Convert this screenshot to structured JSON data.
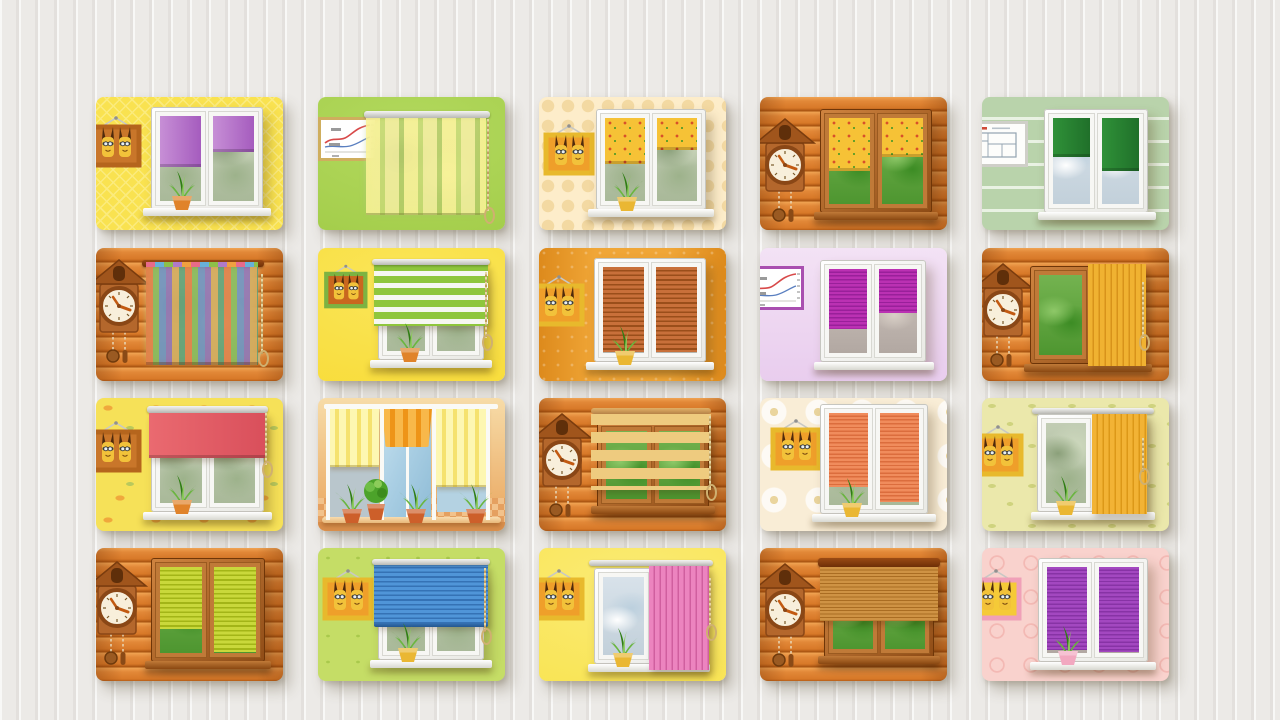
{
  "canvas": {
    "width": 1280,
    "height": 720,
    "background": "#eceae7",
    "stripe": "#d8d5d0"
  },
  "grid": {
    "cols_x": [
      96,
      318,
      539,
      760,
      982
    ],
    "rows_y": [
      97,
      248,
      398,
      548
    ],
    "card_w": 187,
    "card_h": 133,
    "radius": 8
  },
  "palette": {
    "pvc_frame": "#f6f6f2",
    "wood_frame": "#b4672c",
    "pots": {
      "orange": "#e0832a",
      "yellow": "#eab733",
      "pink": "#f2a8c0"
    },
    "critter_body": "#f2c23a",
    "critter_ear": "#4f2a0c",
    "chain_gold": "#cfb070"
  },
  "cards": [
    {
      "id": "r1c1",
      "name": "purple-roller-blinds",
      "wall": {
        "type": "diamond",
        "c1": "#f9e250",
        "c2": "#fbeb7d"
      },
      "elements": [
        {
          "kind": "frame",
          "frame": "#b5651d",
          "inner": "#c9762a",
          "x": -8,
          "y": 16
        },
        {
          "kind": "window",
          "wtype": "pvc",
          "x": 55,
          "y": 10,
          "w": 112,
          "h": 103,
          "view": "garden",
          "blind": {
            "type": "roller",
            "c1": "#c78fd6",
            "c2": "#a55cbe",
            "heights": [
              60,
              42
            ]
          }
        },
        {
          "kind": "sill",
          "x": 47,
          "y": 111,
          "w": 128
        },
        {
          "kind": "plant",
          "x": 66,
          "y": 72,
          "pot": "orange"
        }
      ]
    },
    {
      "id": "r1c2",
      "name": "panel-curtain",
      "wall": {
        "type": "plain",
        "c1": "#9fca45",
        "c2": "#b3d95e"
      },
      "elements": [
        {
          "kind": "chart",
          "frame": "#cfae5e",
          "x": 0,
          "y": 20
        },
        {
          "kind": "backdrop",
          "x": 50,
          "y": 21,
          "w": 114,
          "h": 94
        },
        {
          "kind": "rail",
          "style": "silver",
          "x": 46,
          "y": 14,
          "w": 126,
          "h": 7
        },
        {
          "kind": "panel-curtain",
          "x": 48,
          "y": 21,
          "w": 120,
          "h": 95
        },
        {
          "kind": "chain",
          "x": 169,
          "y": 22,
          "h": 92
        }
      ]
    },
    {
      "id": "r1c3",
      "name": "flower-roller-blinds",
      "wall": {
        "type": "dots",
        "c1": "#fdedca",
        "c2": "#f3d9a2"
      },
      "elements": [
        {
          "kind": "frame",
          "frame": "#e8b92c",
          "inner": "#ef9f2a",
          "x": 2,
          "y": 24
        },
        {
          "kind": "window",
          "wtype": "pvc",
          "x": 57,
          "y": 12,
          "w": 110,
          "h": 101,
          "view": "garden",
          "blind": {
            "type": "roller-flower",
            "heights": [
              55,
              38
            ]
          }
        },
        {
          "kind": "sill",
          "x": 49,
          "y": 112,
          "w": 126
        },
        {
          "kind": "plant",
          "x": 68,
          "y": 73,
          "pot": "yellow"
        }
      ]
    },
    {
      "id": "r1c4",
      "name": "flower-roller-blinds-wood",
      "wall": {
        "type": "wood",
        "c1": "#d97b26",
        "c2": "#a65210"
      },
      "elements": [
        {
          "kind": "clock",
          "x": -6,
          "y": 20
        },
        {
          "kind": "window",
          "wtype": "wood",
          "x": 60,
          "y": 12,
          "w": 112,
          "h": 104,
          "view": "bright",
          "blind": {
            "type": "roller-flower",
            "heights": [
              62,
              45
            ]
          }
        },
        {
          "kind": "sill",
          "x": 54,
          "y": 115,
          "w": 124,
          "wood": true
        }
      ]
    },
    {
      "id": "r1c5",
      "name": "green-roller-blinds",
      "wall": {
        "type": "siding",
        "c1": "#b9d3ab",
        "c2": "#e9f2e3"
      },
      "elements": [
        {
          "kind": "blueprint",
          "x": -16,
          "y": 24
        },
        {
          "kind": "window",
          "wtype": "pvc",
          "x": 62,
          "y": 12,
          "w": 104,
          "h": 104,
          "view": "city",
          "blind": {
            "type": "roller",
            "c1": "#2f9138",
            "c2": "#20702a",
            "heights": [
              45,
              62
            ]
          }
        },
        {
          "kind": "sill",
          "x": 56,
          "y": 115,
          "w": 118
        }
      ]
    },
    {
      "id": "r2c1",
      "name": "multicolor-striped-curtain",
      "wall": {
        "type": "wood",
        "c1": "#d97b26",
        "c2": "#a65210"
      },
      "elements": [
        {
          "kind": "clock",
          "x": -8,
          "y": 10
        },
        {
          "kind": "backdrop",
          "x": 52,
          "y": 19,
          "w": 108,
          "h": 94
        },
        {
          "kind": "rail",
          "style": "dark",
          "x": 46,
          "y": 12,
          "w": 122,
          "h": 7
        },
        {
          "kind": "drape",
          "x": 50,
          "y": 19,
          "w": 112,
          "h": 95
        },
        {
          "kind": "chain",
          "x": 165,
          "y": 26,
          "h": 80
        }
      ]
    },
    {
      "id": "r2c2",
      "name": "green-zebra-blind",
      "wall": {
        "type": "plain",
        "c1": "#f8da33",
        "c2": "#fae65a"
      },
      "elements": [
        {
          "kind": "frame",
          "frame": "#7cb342",
          "inner": "#c9671f",
          "x": 4,
          "y": 14,
          "scale": 0.85
        },
        {
          "kind": "window",
          "wtype": "pvc",
          "x": 60,
          "y": 24,
          "w": 106,
          "h": 88,
          "view": "garden"
        },
        {
          "kind": "sill",
          "x": 52,
          "y": 112,
          "w": 122
        },
        {
          "kind": "overlay-blind",
          "btype": "zebra",
          "x": 56,
          "y": 16,
          "w": 114,
          "h": 62,
          "c1": "#8fc63c",
          "c2": "#f6f7f1",
          "cassette": true
        },
        {
          "kind": "chain",
          "x": 167,
          "y": 24,
          "h": 66
        },
        {
          "kind": "plant",
          "x": 72,
          "y": 73,
          "pot": "orange"
        }
      ]
    },
    {
      "id": "r2c3",
      "name": "wooden-venetian-blinds",
      "wall": {
        "type": "amber",
        "c1": "#f0a637",
        "c2": "#dd8a1c"
      },
      "elements": [
        {
          "kind": "frame",
          "frame": "#e8b92c",
          "inner": "#ef9f2a",
          "x": -8,
          "y": 24
        },
        {
          "kind": "window",
          "wtype": "pvc",
          "x": 55,
          "y": 10,
          "w": 112,
          "h": 104,
          "view": "none",
          "blind": {
            "type": "venetian",
            "c1": "#c8703a",
            "c2": "#9a4e1a",
            "heights": [
              99,
              99
            ]
          }
        },
        {
          "kind": "sill",
          "x": 47,
          "y": 114,
          "w": 128
        },
        {
          "kind": "plant",
          "x": 66,
          "y": 76,
          "pot": "yellow"
        }
      ]
    },
    {
      "id": "r2c4",
      "name": "magenta-pleated-blinds",
      "wall": {
        "type": "lilac",
        "c1": "#e9cdee",
        "c2": "#f3e2f5"
      },
      "elements": [
        {
          "kind": "chart",
          "frame": "#a94fb0",
          "x": -16,
          "y": 18
        },
        {
          "kind": "window",
          "wtype": "pvc",
          "x": 60,
          "y": 12,
          "w": 106,
          "h": 102,
          "view": "dusk",
          "blind": {
            "type": "pleated",
            "c1": "#bb31b3",
            "c2": "#99209a",
            "heights": [
              72,
              52
            ]
          }
        },
        {
          "kind": "sill",
          "x": 54,
          "y": 114,
          "w": 120
        }
      ]
    },
    {
      "id": "r2c5",
      "name": "yellow-vertical-blinds-wood",
      "wall": {
        "type": "wood",
        "c1": "#d97b26",
        "c2": "#a65210"
      },
      "elements": [
        {
          "kind": "clock",
          "x": -10,
          "y": 14
        },
        {
          "kind": "window",
          "wtype": "wood",
          "x": 48,
          "y": 18,
          "w": 116,
          "h": 98,
          "view": "bright"
        },
        {
          "kind": "sill",
          "x": 42,
          "y": 116,
          "w": 128,
          "wood": true
        },
        {
          "kind": "overlay-blind",
          "btype": "vertical",
          "x": 106,
          "y": 16,
          "w": 58,
          "h": 102,
          "c1": "#f0b231",
          "c2": "#d8931a"
        },
        {
          "kind": "chain",
          "x": 160,
          "y": 34,
          "h": 56
        }
      ]
    },
    {
      "id": "r3c1",
      "name": "red-roller-blind",
      "wall": {
        "type": "floral",
        "c1": "#f6e158",
        "c2": "#f0a83c"
      },
      "elements": [
        {
          "kind": "frame",
          "frame": "#b5651d",
          "inner": "#c9762a",
          "x": -8,
          "y": 20
        },
        {
          "kind": "window",
          "wtype": "pvc",
          "x": 55,
          "y": 16,
          "w": 113,
          "h": 98,
          "view": "garden"
        },
        {
          "kind": "sill",
          "x": 47,
          "y": 114,
          "w": 129
        },
        {
          "kind": "rail",
          "style": "silver",
          "x": 51,
          "y": 8,
          "w": 121,
          "h": 7
        },
        {
          "kind": "overlay-blind",
          "btype": "roller",
          "x": 53,
          "y": 15,
          "w": 117,
          "h": 45,
          "c1": "#ea6a70",
          "c2": "#d94f5b"
        },
        {
          "kind": "chain",
          "x": 169,
          "y": 15,
          "h": 52
        },
        {
          "kind": "plant",
          "x": 66,
          "y": 75,
          "pot": "orange"
        }
      ]
    },
    {
      "id": "r3c2",
      "name": "terrace-awnings",
      "wall": {
        "type": "plain",
        "c1": "#e9a45c",
        "c2": "#f7dca8"
      },
      "elements": [
        {
          "kind": "terrace",
          "bg1": "#f7dca8",
          "bg2": "#e9a45c",
          "tile1": "#f2c28b",
          "tile2": "#e5a060",
          "glass": "#aacfe4",
          "awn1": "#fdf7b2",
          "awn2": "#f5e26e",
          "awnO1": "#f8b84a",
          "awnO2": "#ee9418",
          "post": "#fafaf6"
        }
      ]
    },
    {
      "id": "r3c3",
      "name": "wooden-zebra-blind",
      "wall": {
        "type": "wood",
        "c1": "#d97b26",
        "c2": "#a65210"
      },
      "elements": [
        {
          "kind": "clock",
          "x": -8,
          "y": 14
        },
        {
          "kind": "window",
          "wtype": "wood",
          "x": 58,
          "y": 24,
          "w": 112,
          "h": 86,
          "view": "bright"
        },
        {
          "kind": "sill",
          "x": 52,
          "y": 108,
          "w": 124,
          "wood": true
        },
        {
          "kind": "rail",
          "style": "tan",
          "x": 52,
          "y": 10,
          "w": 120,
          "h": 6
        },
        {
          "kind": "overlay-blind",
          "btype": "woodzebra",
          "x": 52,
          "y": 16,
          "w": 120,
          "h": 76,
          "c1": "#eecb7f",
          "c2": "#eecb7f"
        },
        {
          "kind": "chain",
          "x": 170,
          "y": 18,
          "h": 72
        }
      ]
    },
    {
      "id": "r3c4",
      "name": "salmon-pleated-blinds",
      "wall": {
        "type": "daisy",
        "c1": "#f9edd6",
        "c2": "#ead59e"
      },
      "elements": [
        {
          "kind": "frame",
          "frame": "#e8b92c",
          "inner": "#ef9f2a",
          "x": 8,
          "y": 18
        },
        {
          "kind": "window",
          "wtype": "pvc",
          "x": 60,
          "y": 6,
          "w": 108,
          "h": 110,
          "view": "garden",
          "blind": {
            "type": "pleated",
            "c1": "#f08c5c",
            "c2": "#db6d3d",
            "heights": [
              80,
              97
            ]
          }
        },
        {
          "kind": "sill",
          "x": 52,
          "y": 116,
          "w": 124
        },
        {
          "kind": "plant",
          "x": 72,
          "y": 78,
          "pot": "yellow"
        }
      ]
    },
    {
      "id": "r3c5",
      "name": "amber-vertical-blinds",
      "wall": {
        "type": "leaf",
        "c1": "#ebe8ab",
        "c2": "#cfd37e"
      },
      "elements": [
        {
          "kind": "frame",
          "frame": "#e8b92c",
          "inner": "#ef9f2a",
          "x": -12,
          "y": 24
        },
        {
          "kind": "rail",
          "style": "silver",
          "x": 50,
          "y": 10,
          "w": 122,
          "h": 6
        },
        {
          "kind": "window",
          "wtype": "pvc",
          "x": 55,
          "y": 16,
          "w": 110,
          "h": 98,
          "view": "garden"
        },
        {
          "kind": "sill",
          "x": 49,
          "y": 114,
          "w": 124
        },
        {
          "kind": "overlay-blind",
          "btype": "vertical",
          "x": 110,
          "y": 16,
          "w": 55,
          "h": 100,
          "c1": "#f2b335",
          "c2": "#dc9818"
        },
        {
          "kind": "chain",
          "x": 160,
          "y": 40,
          "h": 34
        },
        {
          "kind": "plant",
          "x": 64,
          "y": 76,
          "pot": "yellow"
        }
      ]
    },
    {
      "id": "r4c1",
      "name": "lime-venetian-blinds-wood",
      "wall": {
        "type": "wood",
        "c1": "#d97b26",
        "c2": "#a65210"
      },
      "elements": [
        {
          "kind": "clock",
          "x": -10,
          "y": 12
        },
        {
          "kind": "window",
          "wtype": "wood",
          "x": 55,
          "y": 10,
          "w": 114,
          "h": 104,
          "view": "bright",
          "blind": {
            "type": "venetian",
            "c1": "#c9d83b",
            "c2": "#a3b517",
            "heights": [
              72,
              99
            ]
          }
        },
        {
          "kind": "sill",
          "x": 49,
          "y": 113,
          "w": 126,
          "wood": true
        }
      ]
    },
    {
      "id": "r4c2",
      "name": "blue-venetian-blind",
      "wall": {
        "type": "motif",
        "c1": "#c5dd66",
        "c2": "#a9c94c"
      },
      "elements": [
        {
          "kind": "frame",
          "frame": "#e8b92c",
          "inner": "#ef9f2a",
          "x": 2,
          "y": 18
        },
        {
          "kind": "window",
          "wtype": "pvc",
          "x": 60,
          "y": 24,
          "w": 106,
          "h": 88,
          "view": "garden"
        },
        {
          "kind": "sill",
          "x": 52,
          "y": 112,
          "w": 122
        },
        {
          "kind": "overlay-blind",
          "btype": "venetian",
          "x": 56,
          "y": 16,
          "w": 114,
          "h": 62,
          "c1": "#5095d8",
          "c2": "#3572b5",
          "cassette": true,
          "rail": true
        },
        {
          "kind": "chain",
          "x": 166,
          "y": 20,
          "h": 64
        },
        {
          "kind": "plant",
          "x": 70,
          "y": 73,
          "pot": "yellow"
        }
      ]
    },
    {
      "id": "r4c3",
      "name": "pink-vertical-blinds",
      "wall": {
        "type": "sun",
        "c1": "#f8e34e",
        "c2": "#fbeb76"
      },
      "elements": [
        {
          "kind": "frame",
          "frame": "#e8b92c",
          "inner": "#ef9f2a",
          "x": -8,
          "y": 18
        },
        {
          "kind": "rail",
          "style": "silver",
          "x": 50,
          "y": 12,
          "w": 124,
          "h": 6
        },
        {
          "kind": "window",
          "wtype": "pvc",
          "x": 55,
          "y": 20,
          "w": 112,
          "h": 96,
          "view": "city"
        },
        {
          "kind": "sill",
          "x": 49,
          "y": 116,
          "w": 122
        },
        {
          "kind": "overlay-blind",
          "btype": "vertical",
          "x": 110,
          "y": 18,
          "w": 60,
          "h": 104,
          "c1": "#ec84bf",
          "c2": "#d05f9f"
        },
        {
          "kind": "chain",
          "x": 170,
          "y": 30,
          "h": 50
        },
        {
          "kind": "plant",
          "x": 64,
          "y": 78,
          "pot": "yellow"
        }
      ]
    },
    {
      "id": "r4c4",
      "name": "bamboo-roll-up-blind",
      "wall": {
        "type": "wood",
        "c1": "#d97b26",
        "c2": "#a65210"
      },
      "elements": [
        {
          "kind": "clock",
          "x": -6,
          "y": 14
        },
        {
          "kind": "window",
          "wtype": "wood",
          "x": 64,
          "y": 26,
          "w": 110,
          "h": 84,
          "view": "bright"
        },
        {
          "kind": "sill",
          "x": 58,
          "y": 108,
          "w": 122,
          "wood": true
        },
        {
          "kind": "rail",
          "style": "dark",
          "x": 58,
          "y": 10,
          "w": 122,
          "h": 9
        },
        {
          "kind": "overlay-blind",
          "btype": "bamboo",
          "x": 60,
          "y": 19,
          "w": 118,
          "h": 54,
          "c1": "#cf9344",
          "c2": "#aa6d22"
        }
      ]
    },
    {
      "id": "r4c5",
      "name": "purple-pleated-blinds",
      "wall": {
        "type": "damask",
        "c1": "#f9d2cd",
        "c2": "#f3b9b4"
      },
      "elements": [
        {
          "kind": "frame",
          "frame": "#f0a0b8",
          "inner": "#f5ca38",
          "x": -14,
          "y": 18
        },
        {
          "kind": "window",
          "wtype": "pvc",
          "x": 56,
          "y": 10,
          "w": 110,
          "h": 104,
          "view": "dusk",
          "blind": {
            "type": "pleated",
            "c1": "#a348c0",
            "c2": "#8733a5",
            "heights": [
              96,
              99
            ]
          }
        },
        {
          "kind": "sill",
          "x": 48,
          "y": 114,
          "w": 126
        },
        {
          "kind": "plant",
          "x": 66,
          "y": 76,
          "pot": "pink"
        }
      ]
    }
  ]
}
